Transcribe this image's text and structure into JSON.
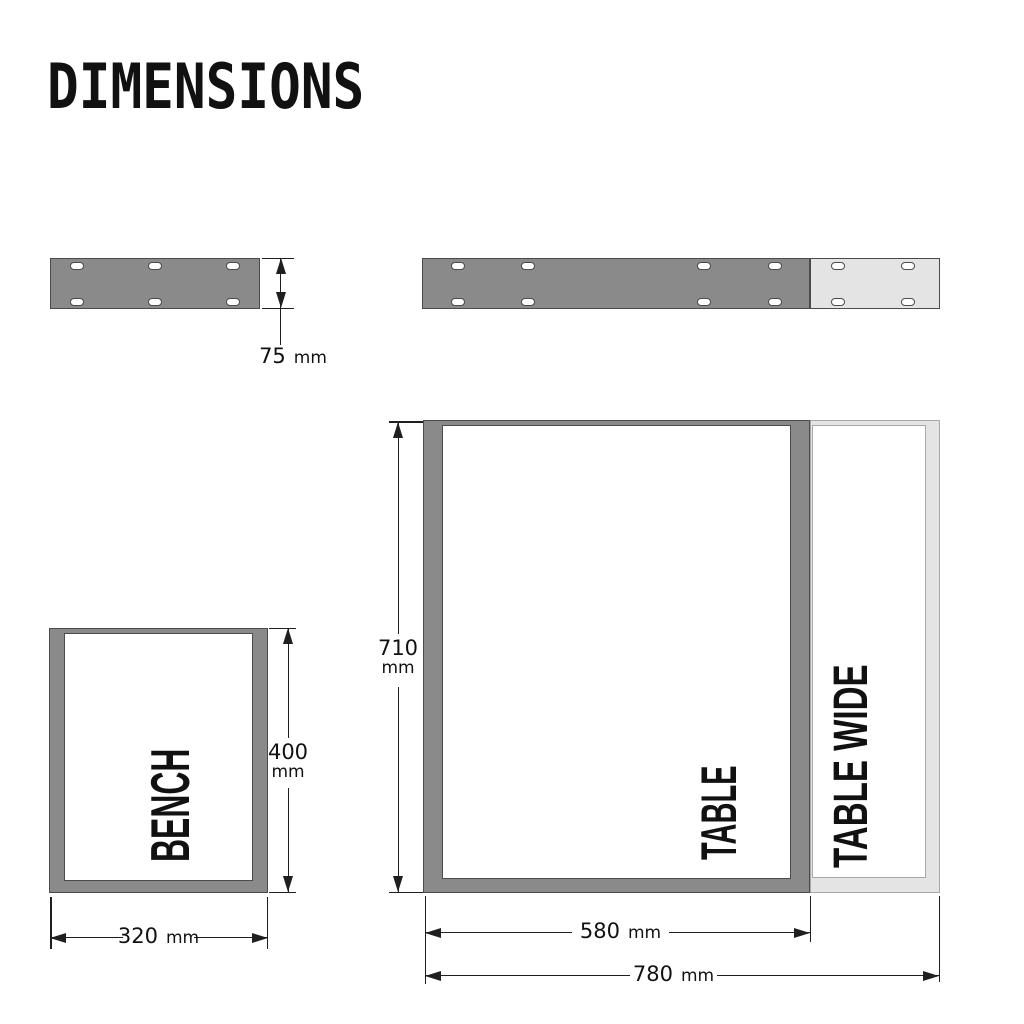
{
  "title": "DIMENSIONS",
  "colors": {
    "plate_dark": "#8a8a8a",
    "plate_light": "#e4e4e4",
    "outline_dark": "#4b4b4b",
    "outline_light": "#a8a8a8",
    "line": "#1f1f1f",
    "text": "#111111",
    "background": "#ffffff"
  },
  "plates": {
    "thickness": {
      "value": "75",
      "unit": "mm"
    }
  },
  "bench": {
    "label": "BENCH",
    "width": {
      "value": "320",
      "unit": "mm"
    },
    "height": {
      "value": "400",
      "unit": "mm"
    }
  },
  "table": {
    "label": "TABLE",
    "width": {
      "value": "580",
      "unit": "mm"
    },
    "height": {
      "value": "710",
      "unit": "mm"
    }
  },
  "table_wide": {
    "label": "TABLE WIDE",
    "width": {
      "value": "780",
      "unit": "mm"
    }
  }
}
